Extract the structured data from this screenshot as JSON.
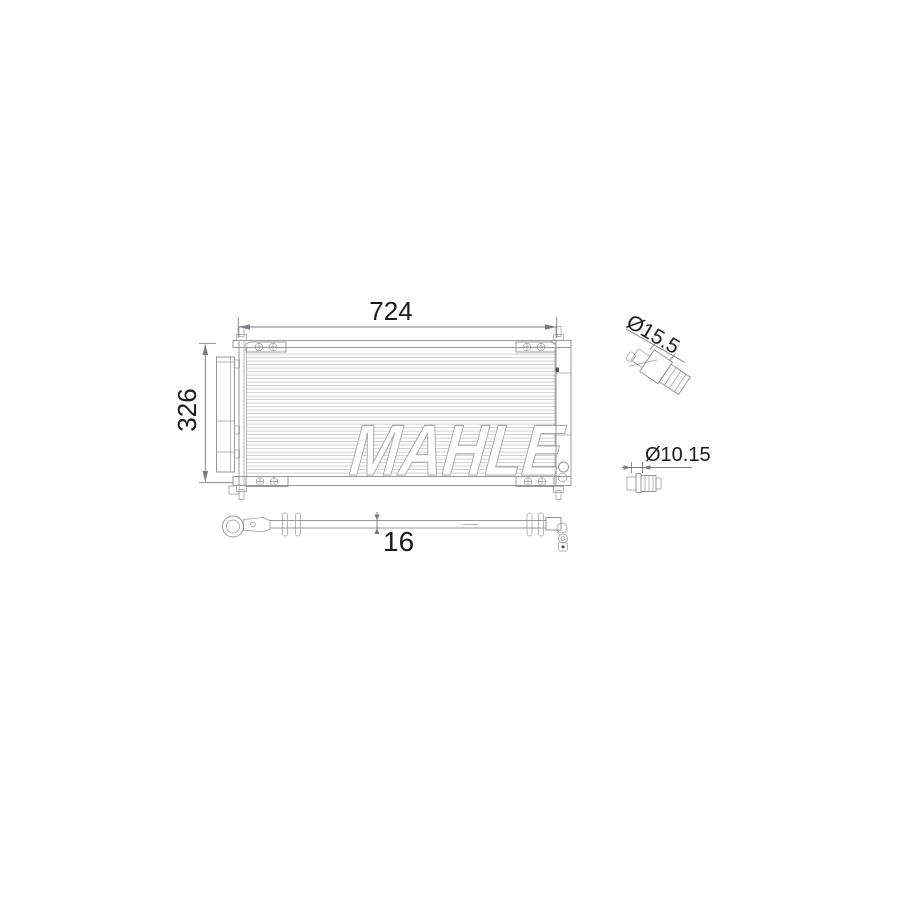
{
  "drawing": {
    "kind": "ac-condenser-technical-drawing",
    "watermark": "MAHLE",
    "dimensions": {
      "width_label": "724",
      "height_label": "326",
      "depth_label": "16",
      "port_top_label": "Ø15.5",
      "port_bottom_label": "Ø10.15"
    },
    "colors": {
      "line": "#97979b",
      "fin": "#c6c6c6",
      "dim_line": "#7c7c80",
      "dim_text": "#1b1b1b",
      "watermark_stroke": "#a6a6a6"
    }
  }
}
